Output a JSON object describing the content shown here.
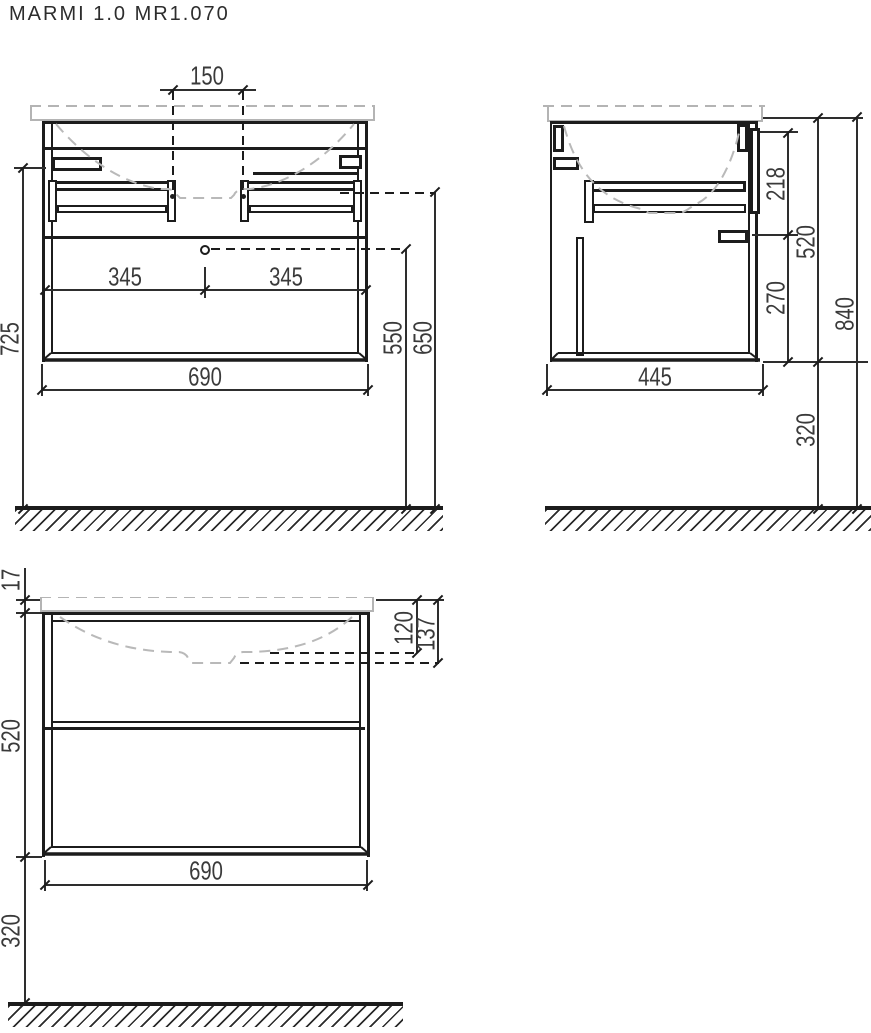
{
  "title": "MARMI 1.0 MR1.070",
  "colors": {
    "line": "#1c1c1c",
    "dimension": "#2e2e2e",
    "countertop": "#b4b4b4",
    "basin_outline": "#b9b9b9",
    "label_text": "#3a3a3a"
  },
  "views": {
    "front": {
      "dims": {
        "faucet_spacing": "150",
        "half_width_left": "345",
        "half_width_right": "345",
        "cabinet_width": "690",
        "wall_height": "725",
        "drain_height": "550",
        "rail_height": "650"
      }
    },
    "side": {
      "dims": {
        "depth": "445",
        "top_to_bracket": "218",
        "bracket_to_bottom": "270",
        "cabinet_height": "520",
        "floor_clearance": "320",
        "total_height": "840"
      }
    },
    "front_closed": {
      "dims": {
        "countertop_thickness": "17",
        "basin_depth_inner": "120",
        "basin_depth_overall": "137",
        "cabinet_height": "520",
        "cabinet_width": "690",
        "floor_clearance": "320"
      }
    }
  }
}
